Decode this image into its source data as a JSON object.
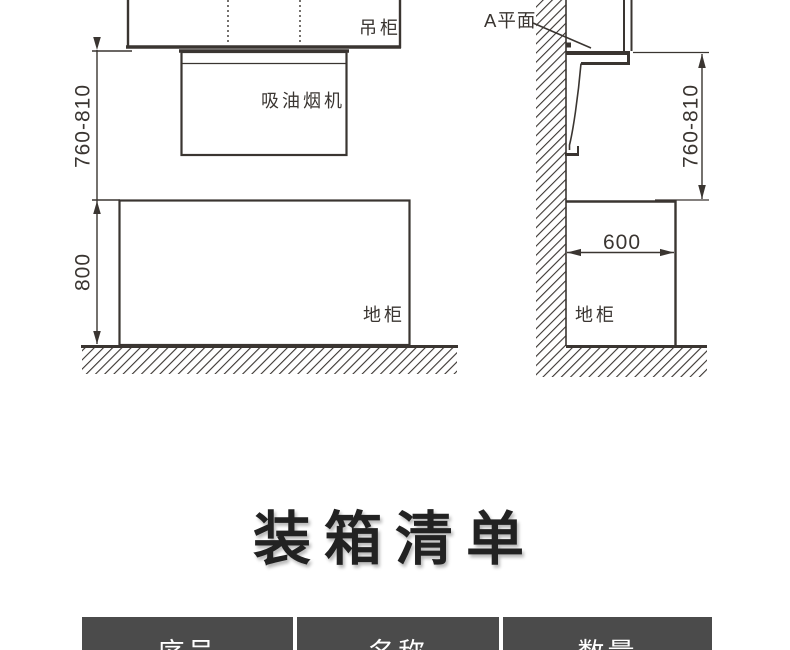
{
  "colors": {
    "line_color": "#3a3531",
    "title_color": "#222222",
    "table_header_bg": "#4b4b4b",
    "table_header_text": "#ffffff"
  },
  "diagram_front": {
    "wall_cabinet_label": "吊柜",
    "hood_label": "吸油烟机",
    "base_cabinet_label": "地柜",
    "dim_hood_to_counter": "760-810",
    "dim_base_cabinet_height": "800"
  },
  "diagram_side": {
    "plane_label": "A平面",
    "dim_hood_to_counter": "760-810",
    "dim_base_cabinet_depth": "600",
    "base_cabinet_label": "地柜"
  },
  "packing_list": {
    "title": "装箱清单",
    "columns": [
      "序号",
      "名称",
      "数量"
    ]
  }
}
